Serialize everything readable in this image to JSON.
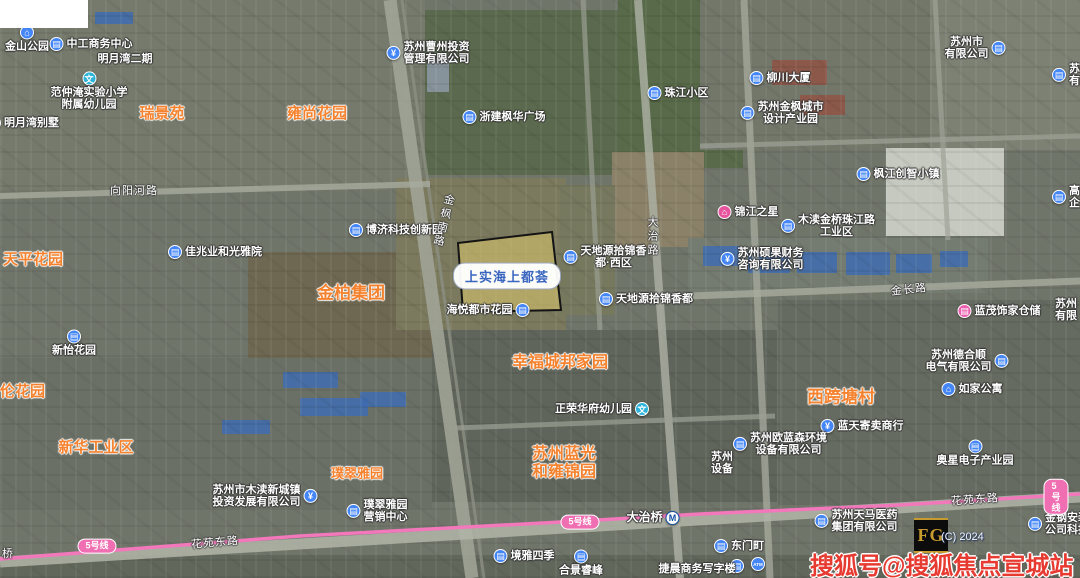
{
  "map": {
    "watermark": "搜狐号@搜狐焦点宣城站",
    "watermark_color": "#e73a31",
    "copyright": "(C) 2024",
    "fg_logo": "FG",
    "parcel": {
      "label": "上实海上都荟",
      "points": "458,243 552,232 561,310 463,312",
      "fill": "rgba(213,195,108,0.60)",
      "border": "#141414"
    },
    "metro_line": {
      "name": "5号线",
      "color": "#f277bb",
      "badges": [
        {
          "x": 97,
          "y": 546
        },
        {
          "x": 580,
          "y": 522
        },
        {
          "x": 1056,
          "y": 497
        }
      ]
    },
    "icon_colors": {
      "blue": "#4586f6",
      "teal": "#2bb3d9",
      "pink": "#e8559f"
    },
    "labels": [
      {
        "id": "estate-ruijingyuan",
        "kind": "estate",
        "x": 162,
        "y": 114,
        "text": "瑞景苑",
        "size": 15
      },
      {
        "id": "estate-yongshanghuayuan",
        "kind": "estate",
        "x": 317,
        "y": 114,
        "text": "雍尚花园",
        "size": 15
      },
      {
        "id": "estate-tianpinghuayuan",
        "kind": "estate",
        "x": 3,
        "y": 260,
        "text": "天平花园",
        "size": 15,
        "anchor": "left"
      },
      {
        "id": "estate-jinbaijituan",
        "kind": "estate",
        "x": 351,
        "y": 294,
        "text": "金柏集团",
        "size": 17
      },
      {
        "id": "estate-xinhuagongyequ",
        "kind": "estate",
        "x": 96,
        "y": 448,
        "text": "新华工业区",
        "size": 15
      },
      {
        "id": "estate-pucuiyayuan",
        "kind": "estate",
        "x": 357,
        "y": 474,
        "text": "璞翠雅园",
        "size": 13
      },
      {
        "id": "estate-lunhuayuan",
        "kind": "estate",
        "x": 0,
        "y": 392,
        "text": "伦花园",
        "size": 15,
        "anchor": "left"
      },
      {
        "id": "estate-xikuatangcun",
        "kind": "estate",
        "x": 841,
        "y": 398,
        "text": "西跨塘村",
        "size": 17
      },
      {
        "id": "estate-xingfuchengbang",
        "kind": "estate",
        "x": 560,
        "y": 363,
        "text": "幸福城邦家园",
        "size": 16
      },
      {
        "id": "estate-suzhoulanguang",
        "kind": "estate",
        "x": 564,
        "y": 463,
        "lines": [
          "苏州蓝光",
          "和雍锦园"
        ],
        "size": 16
      },
      {
        "id": "poi-jinshangongyuan",
        "kind": "poi",
        "x": 27,
        "y": 39,
        "text": "金山公园",
        "icon": "temple-icon",
        "iconColor": "#4586f6",
        "iconPos": "top"
      },
      {
        "id": "poi-zhonggongshangwu",
        "kind": "poi",
        "x": 91,
        "y": 44,
        "text": "中工商务中心",
        "icon": "building-icon",
        "iconColor": "#4586f6"
      },
      {
        "id": "poi-mingyuewanerqi",
        "kind": "poi",
        "x": 125,
        "y": 59,
        "text": "明月湾二期"
      },
      {
        "id": "poi-fanzhongyan-school",
        "kind": "poi",
        "x": 89,
        "y": 91,
        "lines": [
          "范仲淹实验小学",
          "附属幼儿园"
        ],
        "icon": "school-icon",
        "iconColor": "#2bb3d9",
        "iconPos": "top"
      },
      {
        "id": "poi-mingyuewanbieshu",
        "kind": "poi",
        "x": 23,
        "y": 123,
        "text": "明月湾别墅",
        "icon": "building-icon",
        "iconColor": "#4586f6"
      },
      {
        "id": "poi-caozhoutouzi",
        "kind": "poi",
        "x": 428,
        "y": 53,
        "lines": [
          "苏州曹州投资",
          "管理有限公司"
        ],
        "icon": "finance-icon",
        "iconColor": "#4586f6"
      },
      {
        "id": "poi-zhejianfenghua",
        "kind": "poi",
        "x": 504,
        "y": 117,
        "text": "浙建枫华广场",
        "icon": "building-icon",
        "iconColor": "#4586f6"
      },
      {
        "id": "poi-zhujiangxiaoqu",
        "kind": "poi",
        "x": 678,
        "y": 93,
        "text": "珠江小区",
        "icon": "building-icon",
        "iconColor": "#4586f6"
      },
      {
        "id": "poi-liuchuandasha",
        "kind": "poi",
        "x": 780,
        "y": 78,
        "text": "柳川大厦",
        "icon": "building-icon",
        "iconColor": "#4586f6"
      },
      {
        "id": "poi-jinfengchanyeyuan",
        "kind": "poi",
        "x": 782,
        "y": 113,
        "lines": [
          "苏州金枫城市",
          "设计产业园"
        ],
        "icon": "building-icon",
        "iconColor": "#4586f6"
      },
      {
        "id": "poi-company-topright",
        "kind": "poi",
        "x": 975,
        "y": 48,
        "lines": [
          "苏州市",
          "有限公司"
        ],
        "icon": "building-icon",
        "iconColor": "#4586f6",
        "iconPos": "right"
      },
      {
        "id": "poi-company-edge-top",
        "kind": "poi",
        "x": 1052,
        "y": 75,
        "lines": [
          "苏州",
          "有限"
        ],
        "icon": "building-icon",
        "iconColor": "#4586f6",
        "anchor": "left"
      },
      {
        "id": "poi-bojikeji",
        "kind": "poi",
        "x": 396,
        "y": 230,
        "text": "博济科技创新园",
        "icon": "building-icon",
        "iconColor": "#4586f6"
      },
      {
        "id": "poi-jiazhaoye",
        "kind": "poi",
        "x": 215,
        "y": 252,
        "text": "佳兆业和光雅院",
        "icon": "building-icon",
        "iconColor": "#4586f6"
      },
      {
        "id": "poi-haiyuedushi",
        "kind": "poi",
        "x": 488,
        "y": 310,
        "text": "海悦都市花园",
        "icon": "building-icon",
        "iconColor": "#4586f6",
        "iconPos": "right"
      },
      {
        "id": "poi-tiandiyuan-xiqu",
        "kind": "poi",
        "x": 605,
        "y": 257,
        "lines": [
          "天地源拾锦香",
          "都·西区"
        ],
        "icon": "building-icon",
        "iconColor": "#4586f6"
      },
      {
        "id": "poi-tiandiyuan",
        "kind": "poi",
        "x": 646,
        "y": 299,
        "text": "天地源拾锦香都",
        "icon": "building-icon",
        "iconColor": "#4586f6"
      },
      {
        "id": "poi-jinjiangzhixing",
        "kind": "poi",
        "x": 748,
        "y": 212,
        "text": "锦江之星",
        "icon": "hotel-icon",
        "iconColor": "#e8559f"
      },
      {
        "id": "poi-mudugongyequ",
        "kind": "poi",
        "x": 828,
        "y": 226,
        "lines": [
          "木渎金桥珠江路",
          "工业区"
        ],
        "icon": "building-icon",
        "iconColor": "#4586f6"
      },
      {
        "id": "poi-fengjiangchuangzhi",
        "kind": "poi",
        "x": 898,
        "y": 174,
        "text": "枫江创智小镇",
        "icon": "building-icon",
        "iconColor": "#4586f6"
      },
      {
        "id": "poi-shuoguocaiwu",
        "kind": "poi",
        "x": 762,
        "y": 259,
        "lines": [
          "苏州硕果财务",
          "咨询有限公司"
        ],
        "icon": "finance-icon",
        "iconColor": "#4586f6"
      },
      {
        "id": "poi-gaoxinqiye",
        "kind": "poi",
        "x": 1052,
        "y": 197,
        "lines": [
          "高新",
          "企业"
        ],
        "icon": "building-icon",
        "iconColor": "#4586f6",
        "anchor": "left"
      },
      {
        "id": "poi-lanmaocangchu",
        "kind": "poi",
        "x": 999,
        "y": 311,
        "text": "蓝茂饰家仓储",
        "icon": "shop-icon",
        "iconColor": "#ea5fae"
      },
      {
        "id": "poi-deheshun",
        "kind": "poi",
        "x": 967,
        "y": 361,
        "lines": [
          "苏州德合顺",
          "电气有限公司"
        ],
        "icon": "building-icon",
        "iconColor": "#4586f6",
        "iconPos": "right"
      },
      {
        "id": "poi-rujiagongyu",
        "kind": "poi",
        "x": 972,
        "y": 389,
        "text": "如家公寓",
        "icon": "hotel-icon",
        "iconColor": "#4586f6"
      },
      {
        "id": "poi-company-edge-mid",
        "kind": "poi",
        "x": 1055,
        "y": 310,
        "lines": [
          "苏州",
          "有限"
        ],
        "anchor": "left"
      },
      {
        "id": "poi-lantianjimai",
        "kind": "poi",
        "x": 862,
        "y": 426,
        "text": "蓝天寄卖商行",
        "icon": "finance-icon",
        "iconColor": "#4586f6"
      },
      {
        "id": "poi-oulansen",
        "kind": "poi",
        "x": 780,
        "y": 444,
        "lines": [
          "苏州欧蓝森环境",
          "设备有限公司"
        ],
        "icon": "building-icon",
        "iconColor": "#4586f6"
      },
      {
        "id": "poi-partial-shebei",
        "kind": "poi",
        "x": 722,
        "y": 463,
        "lines": [
          "苏州",
          "设备"
        ]
      },
      {
        "id": "poi-aoxing",
        "kind": "poi",
        "x": 975,
        "y": 453,
        "text": "奥星电子产业园",
        "icon": "building-icon",
        "iconColor": "#4586f6",
        "iconPos": "top"
      },
      {
        "id": "poi-zhengrongyoueryuan",
        "kind": "poi",
        "x": 602,
        "y": 409,
        "text": "正荣华府幼儿园",
        "icon": "school-icon",
        "iconColor": "#2bb3d9",
        "iconPos": "right"
      },
      {
        "id": "poi-mudutouzi",
        "kind": "poi",
        "x": 265,
        "y": 496,
        "lines": [
          "苏州市木渎新城镇",
          "投资发展有限公司"
        ],
        "icon": "finance-icon",
        "iconColor": "#4586f6",
        "iconPos": "right"
      },
      {
        "id": "poi-pucuiyingxiao",
        "kind": "poi",
        "x": 377,
        "y": 511,
        "lines": [
          "璞翠雅园",
          "营销中心"
        ],
        "icon": "building-icon",
        "iconColor": "#4586f6"
      },
      {
        "id": "poi-jingyasiji",
        "kind": "poi",
        "x": 524,
        "y": 556,
        "text": "境雅四季",
        "icon": "building-icon",
        "iconColor": "#4586f6"
      },
      {
        "id": "poi-hejingruifeng",
        "kind": "poi",
        "x": 581,
        "y": 563,
        "text": "合景睿峰",
        "icon": "building-icon",
        "iconColor": "#4586f6",
        "iconPos": "top"
      },
      {
        "id": "station-dazhiqiao",
        "kind": "station",
        "x": 653,
        "y": 518,
        "text": "大治桥",
        "icon": "metro-icon",
        "iconPos": "right"
      },
      {
        "id": "poi-dongmending",
        "kind": "poi",
        "x": 739,
        "y": 546,
        "text": "东门町",
        "icon": "building-icon",
        "iconColor": "#4586f6"
      },
      {
        "id": "poi-atm",
        "kind": "poi",
        "x": 758,
        "y": 564,
        "text": "",
        "icon": "atm-icon",
        "iconColor": "#4586f6"
      },
      {
        "id": "poi-dot",
        "kind": "poi",
        "x": 737,
        "y": 566,
        "text": "",
        "icon": "building-icon",
        "iconColor": "#4586f6"
      },
      {
        "id": "poi-jiechenxiezilou",
        "kind": "poi",
        "x": 697,
        "y": 569,
        "text": "捷晨商务写字楼"
      },
      {
        "id": "poi-tianmayiyao",
        "kind": "poi",
        "x": 856,
        "y": 521,
        "lines": [
          "苏州天马医药",
          "集团有限公司"
        ],
        "icon": "building-icon",
        "iconColor": "#4586f6"
      },
      {
        "id": "poi-jingang",
        "kind": "poi",
        "x": 1028,
        "y": 524,
        "lines": [
          "金钢安装",
          "公司科技"
        ],
        "icon": "building-icon",
        "iconColor": "#4586f6",
        "anchor": "left"
      },
      {
        "id": "poi-xinyihuayuan",
        "kind": "poi",
        "x": 74,
        "y": 343,
        "text": "新怡花园",
        "icon": "building-icon",
        "iconColor": "#4586f6",
        "iconPos": "top"
      },
      {
        "id": "road-xiangyanghelu",
        "kind": "road",
        "x": 134,
        "y": 191,
        "text": "向阳河路"
      },
      {
        "id": "road-jinchanglu",
        "kind": "road",
        "x": 909,
        "y": 290,
        "text": "金长路",
        "rot": -6
      },
      {
        "id": "road-huayuandonglu-west",
        "kind": "road",
        "x": 215,
        "y": 543,
        "text": "花苑东路",
        "rot": -5
      },
      {
        "id": "road-huayuandonglu-east",
        "kind": "road",
        "x": 975,
        "y": 500,
        "text": "花苑东路",
        "rot": -4
      },
      {
        "id": "road-qiao-partial",
        "kind": "road",
        "x": 8,
        "y": 554,
        "text": "桥"
      },
      {
        "id": "road-dazhilu",
        "kind": "roadv",
        "x": 652,
        "y": 237,
        "text": "大治路"
      },
      {
        "id": "road-jinfengnanlu",
        "kind": "roadv",
        "x": 443,
        "y": 221,
        "text": "金枫南路",
        "rot": 14
      }
    ]
  }
}
